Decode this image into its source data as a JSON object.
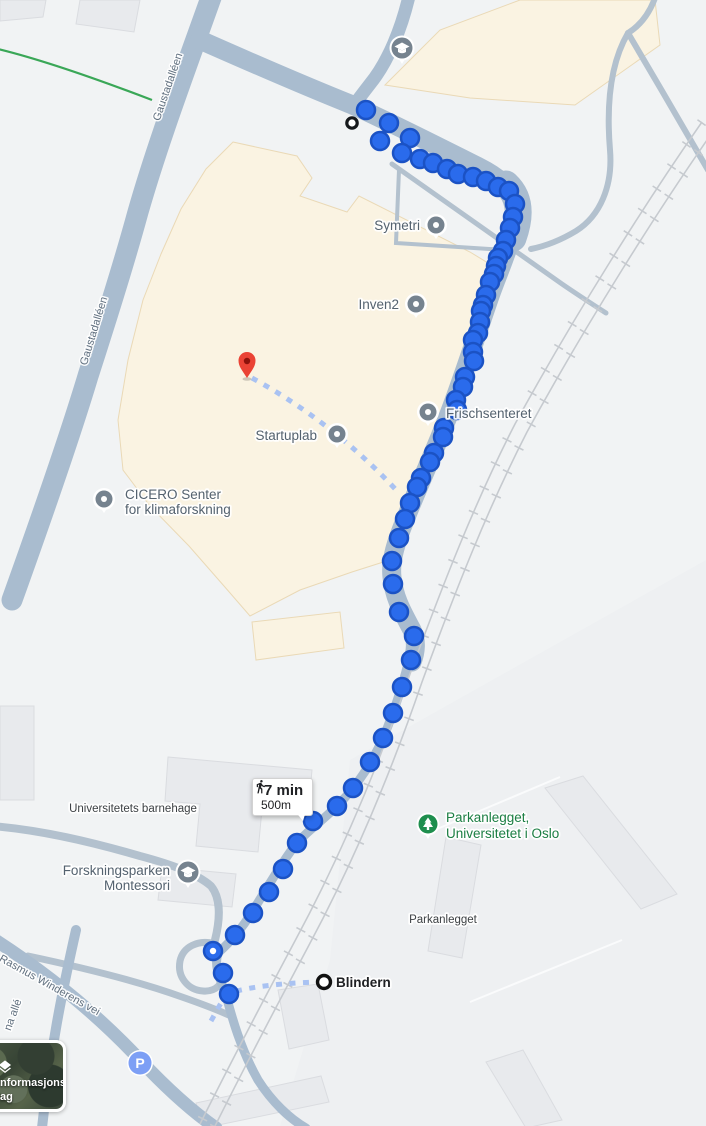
{
  "colors": {
    "background": "#f1f3f4",
    "road": "#a9bccf",
    "campus_fill": "#faf3e2",
    "building_grey": "#e8eaed",
    "railway": "#c6cacf",
    "route_dot_fill": "#2a6bec",
    "route_dot_stroke": "#1b52c4",
    "connector_dash": "#a9c2f2",
    "poi_label_slate": "#54626f",
    "poi_label_green": "#1b7e43",
    "street_label": "#61707f",
    "text_dark": "#202124",
    "destination_pin_red": "#ea4335",
    "park_marker_green": "#1e8e4e",
    "poi_marker_slate": "#76838f",
    "parking_blue": "#7d9ff5"
  },
  "labels": {
    "symetri": {
      "text": "Symetri"
    },
    "inven2": {
      "text": "Inven2"
    },
    "startuplab": {
      "text": "Startuplab"
    },
    "cicero": {
      "line1": "CICERO Senter",
      "line2": "for klimaforskning"
    },
    "frischsenteret": {
      "text": "Frischsenteret"
    },
    "barnehage": {
      "text": "Universitetets barnehage"
    },
    "montessori": {
      "line1": "Forskningsparken",
      "line2": "Montessori"
    },
    "park_uio": {
      "line1": "Parkanlegget,",
      "line2": "Universitetet i Oslo"
    },
    "parkanlegget": {
      "text": "Parkanlegget"
    },
    "blindern": {
      "text": "Blindern"
    },
    "street_gaustadalleen": {
      "text": "Gaustadalléen"
    },
    "street_rasmus": {
      "text": "Rasmus Winderens vei"
    },
    "street_na_alle": {
      "text": "na allé"
    }
  },
  "tooltip": {
    "mode": "walking",
    "duration": "7 min",
    "distance": "500m"
  },
  "parking": {
    "label": "P"
  },
  "layers_button": {
    "line1": "nformasjons-",
    "line2": "ag"
  },
  "route": {
    "waypoint_dot_index": 60,
    "dots": [
      [
        366,
        110
      ],
      [
        389,
        123
      ],
      [
        380,
        141
      ],
      [
        410,
        138
      ],
      [
        402,
        153
      ],
      [
        420,
        159
      ],
      [
        433,
        163
      ],
      [
        447,
        169
      ],
      [
        458,
        174
      ],
      [
        473,
        177
      ],
      [
        486,
        181
      ],
      [
        498,
        187
      ],
      [
        509,
        191
      ],
      [
        515,
        204
      ],
      [
        513,
        217
      ],
      [
        510,
        228
      ],
      [
        506,
        240
      ],
      [
        503,
        251
      ],
      [
        498,
        258
      ],
      [
        496,
        266
      ],
      [
        494,
        274
      ],
      [
        490,
        282
      ],
      [
        486,
        295
      ],
      [
        483,
        305
      ],
      [
        481,
        311
      ],
      [
        480,
        322
      ],
      [
        478,
        333
      ],
      [
        473,
        340
      ],
      [
        473,
        352
      ],
      [
        474,
        361
      ],
      [
        465,
        377
      ],
      [
        463,
        387
      ],
      [
        456,
        400
      ],
      [
        457,
        410
      ],
      [
        444,
        428
      ],
      [
        443,
        437
      ],
      [
        434,
        453
      ],
      [
        430,
        462
      ],
      [
        421,
        478
      ],
      [
        417,
        487
      ],
      [
        410,
        503
      ],
      [
        405,
        519
      ],
      [
        399,
        538
      ],
      [
        392,
        561
      ],
      [
        393,
        584
      ],
      [
        399,
        612
      ],
      [
        414,
        636
      ],
      [
        411,
        660
      ],
      [
        402,
        687
      ],
      [
        393,
        713
      ],
      [
        383,
        738
      ],
      [
        370,
        762
      ],
      [
        353,
        788
      ],
      [
        337,
        806
      ],
      [
        313,
        821
      ],
      [
        297,
        843
      ],
      [
        283,
        869
      ],
      [
        269,
        892
      ],
      [
        253,
        913
      ],
      [
        235,
        935
      ],
      [
        213,
        951
      ],
      [
        223,
        973
      ],
      [
        229,
        994
      ]
    ]
  }
}
